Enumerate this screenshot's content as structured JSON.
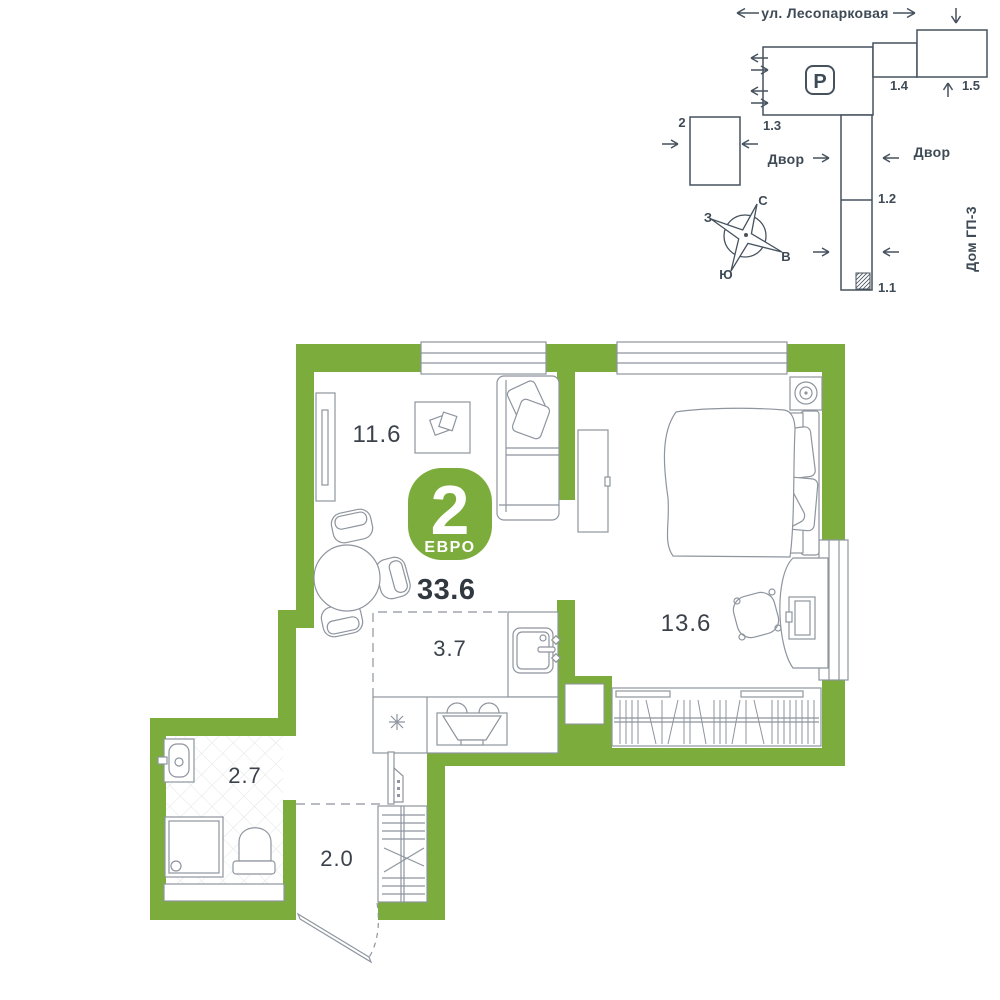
{
  "colors": {
    "wall_green": "#7cac3b",
    "badge_green": "#7cac3b",
    "furniture_line_gray": "#8e959e",
    "site_plan_line": "#46525e",
    "text_dark": "#3b424b"
  },
  "site_plan": {
    "street": "ул. Лесопарковая",
    "yard_left": "Двор",
    "yard_right": "Двор",
    "house_label": "Дом ГП-3",
    "parking": "P",
    "buildings": {
      "b2": "2",
      "b11": "1.1",
      "b12": "1.2",
      "b13": "1.3",
      "b14": "1.4",
      "b15": "1.5"
    },
    "compass": {
      "north": "С",
      "south": "Ю",
      "west": "З",
      "east": "В"
    }
  },
  "plan": {
    "badge": {
      "rooms": "2",
      "type": "ЕВРО"
    },
    "total_area": "33.6",
    "areas": {
      "living": "11.6",
      "bedroom": "13.6",
      "kitchen": "3.7",
      "bathroom": "2.7",
      "hallway": "2.0"
    }
  }
}
